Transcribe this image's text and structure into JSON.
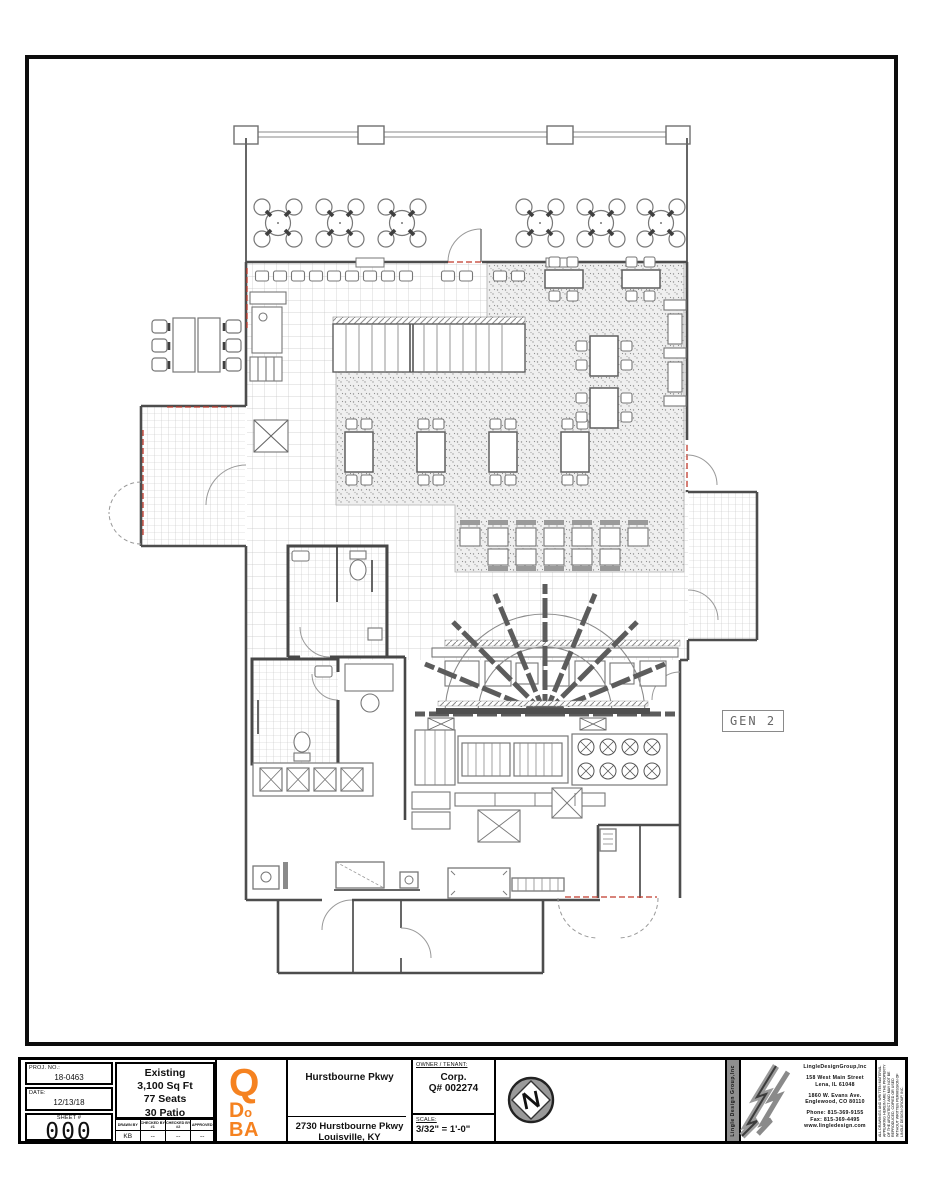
{
  "plan": {
    "gen_label": "GEN 2",
    "colors": {
      "wall": "#4d4d4d",
      "line": "#777777",
      "red_dash": "#c0392b",
      "carpet_dot": "#8f8f8f",
      "tile_line": "#c6c6c6",
      "logo_orange": "#F58220"
    }
  },
  "title_block": {
    "proj_no_label": "PROJ. NO.:",
    "proj_no": "18-0463",
    "date_label": "DATE:",
    "date": "12/13/18",
    "sheet_label": "SHEET #",
    "sheet_no": "000",
    "existing": {
      "line1": "Existing",
      "line2": "3,100 Sq Ft",
      "line3": "77 Seats",
      "line4": "30 Patio"
    },
    "sign_table": {
      "headers": [
        "DRAWN BY",
        "CHECKED BY #1",
        "CHECKED BY #2",
        "APPROVED"
      ],
      "values": [
        "KB",
        "--",
        "--",
        "--"
      ]
    },
    "logo": {
      "q": "Q",
      "d": "D",
      "o": "o",
      "ba": "BA"
    },
    "project": {
      "name": "Hurstbourne Pkwy",
      "address1": "2730 Hurstbourne Pkwy",
      "address2": "Louisville, KY"
    },
    "owner": {
      "label": "OWNER / TENANT:",
      "line1": "Corp.",
      "line2": "Q# 002274"
    },
    "scale": {
      "label": "SCALE:",
      "value": "3/32\" = 1'-0\""
    },
    "firm": {
      "vertical_name": "Lingle Design Group,Inc",
      "name": "LingleDesignGroup,Inc",
      "address1": "158 West Main Street",
      "address2": "Lena, IL 61048",
      "address3": "1860 W. Evans Ave.",
      "address4": "Englewood, CO 80110",
      "phone": "Phone: 815-369-9155",
      "fax": "Fax: 815-369-4495",
      "web": "www.lingledesign.com",
      "disclaimer": "ALL DRAWINGS AND WRITTEN MATERIAL APPEARING HEREIN ARE THE PROPERTY OF THE ARCHITECT AND MAY NOT BE REPRODUCED, COPIED OR USED WITHOUT WRITTEN PERMISSION OF LINGLE DESIGN GROUP, INC."
    }
  }
}
